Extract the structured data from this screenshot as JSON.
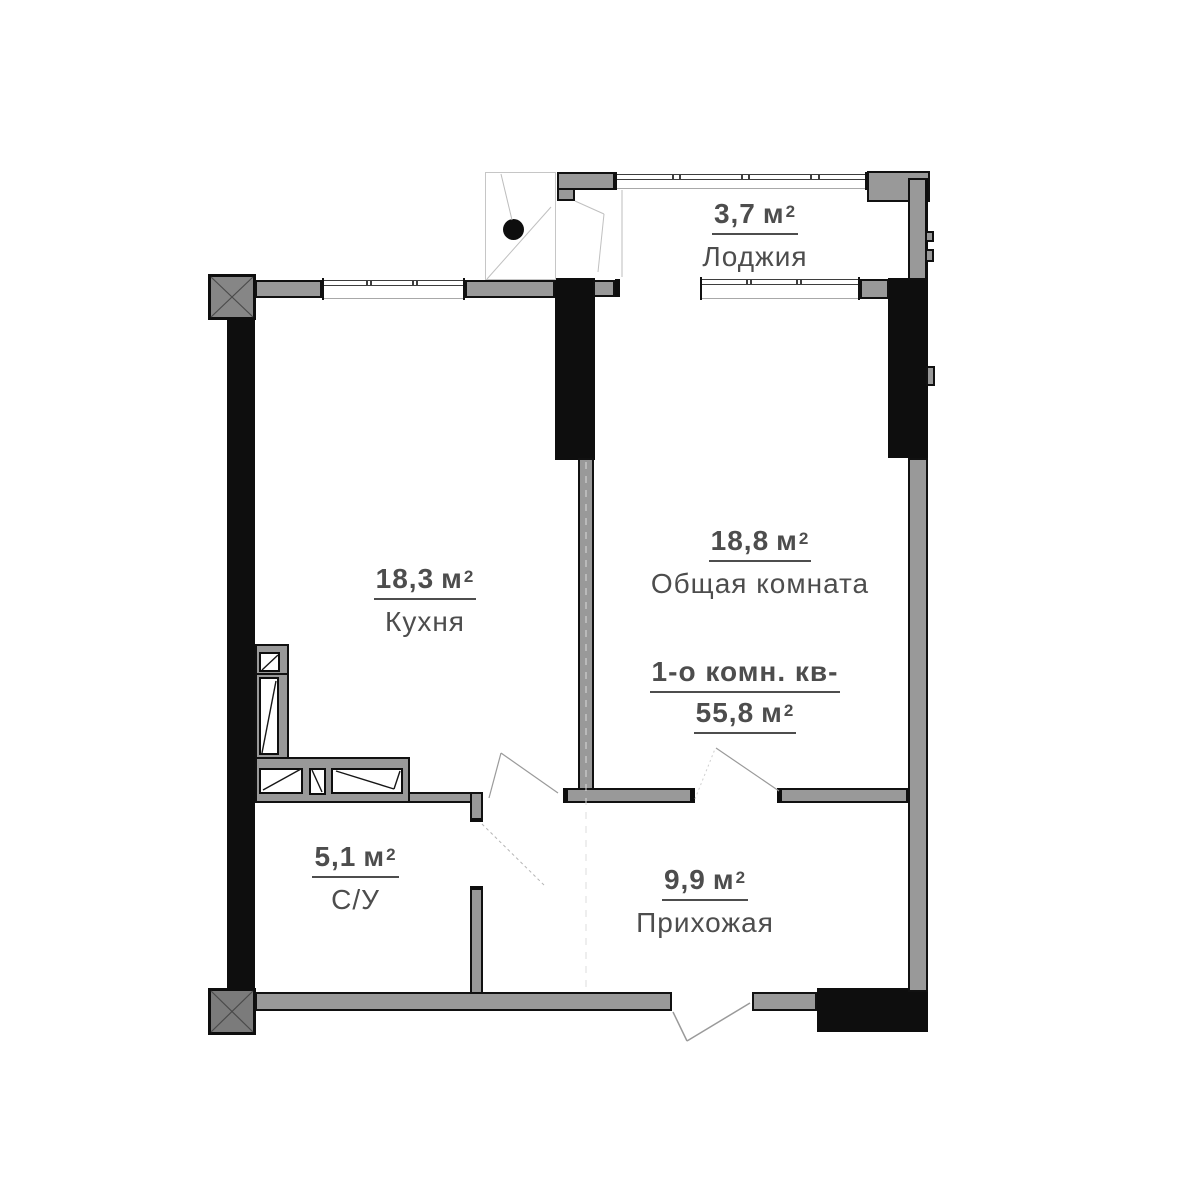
{
  "plan": {
    "rooms": [
      {
        "id": "loggia",
        "name": "Лоджия",
        "area_value": "3,7",
        "area_unit": "м",
        "area_sup": "2"
      },
      {
        "id": "common",
        "name": "Общая комната",
        "area_value": "18,8",
        "area_unit": "м",
        "area_sup": "2"
      },
      {
        "id": "kitchen",
        "name": "Кухня",
        "area_value": "18,3",
        "area_unit": "м",
        "area_sup": "2"
      },
      {
        "id": "bathroom",
        "name": "С/У",
        "area_value": "5,1",
        "area_unit": "м",
        "area_sup": "2"
      },
      {
        "id": "hallway",
        "name": "Прихожая",
        "area_value": "9,9",
        "area_unit": "м",
        "area_sup": "2"
      }
    ],
    "summary": {
      "title": "1-о комн. кв-",
      "total_area_value": "55,8",
      "total_area_unit": "м",
      "total_area_sup": "2"
    },
    "colors": {
      "wall_black": "#0e0e0e",
      "wall_gray": "#999999",
      "column_gray": "#868686",
      "text": "#4d4d4d",
      "window_line": "#3e3e3e"
    }
  }
}
